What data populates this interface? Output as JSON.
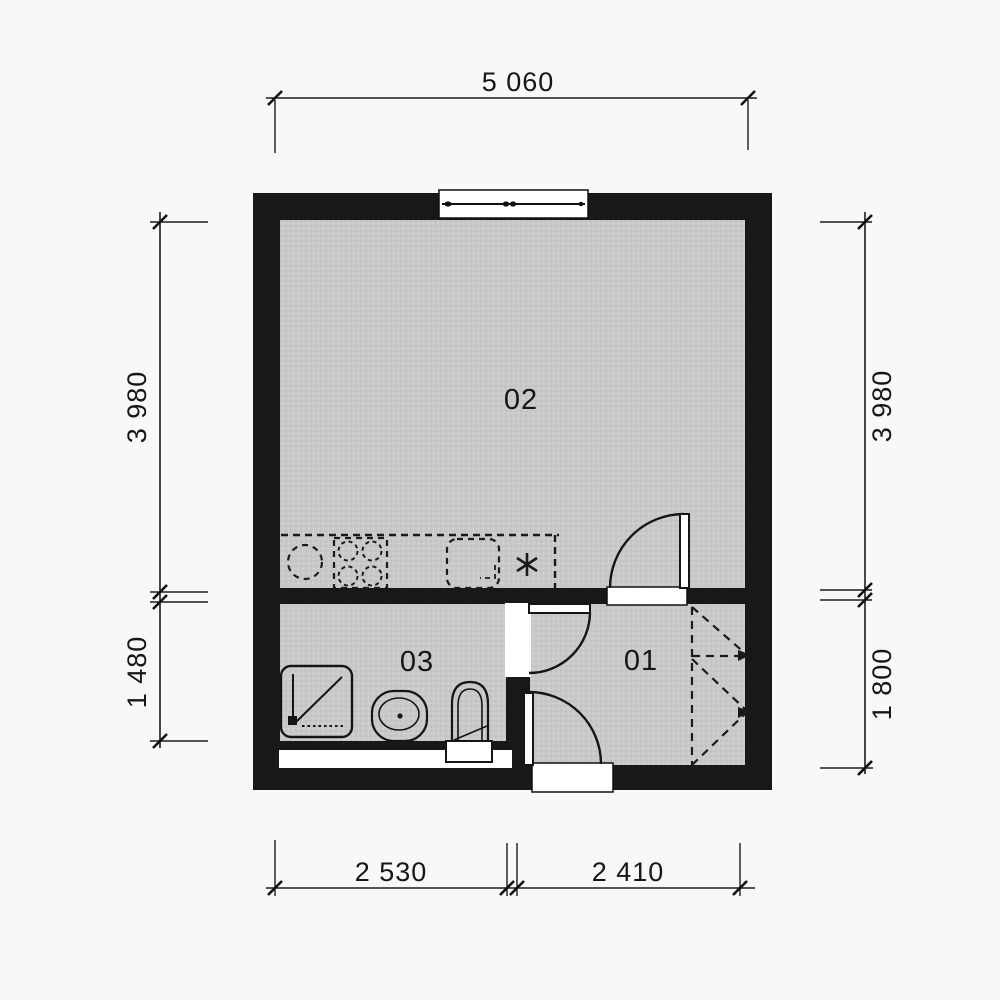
{
  "drawing": {
    "type": "apartment floor plan",
    "rooms": [
      {
        "number": "02"
      },
      {
        "number": "03"
      },
      {
        "number": "01"
      }
    ],
    "dimensions": {
      "top": "5 060",
      "left_upper": "3 980",
      "left_lower": "1 480",
      "right_upper": "3 980",
      "right_lower": "1 800",
      "bottom_left": "2 530",
      "bottom_right": "2 410"
    },
    "symbols": [
      "window",
      "door-swing",
      "kitchen-counter-dashed",
      "stove-burners",
      "kitchen-sink",
      "water-heater-asterisk",
      "shower-tray",
      "washbasin",
      "toilet",
      "built-in-wardrobe-dashed"
    ],
    "colors": {
      "wall": "#181818",
      "floor": "#c9c9c7",
      "paper": "#f8f8f6",
      "line": "#1c1c1c"
    }
  }
}
